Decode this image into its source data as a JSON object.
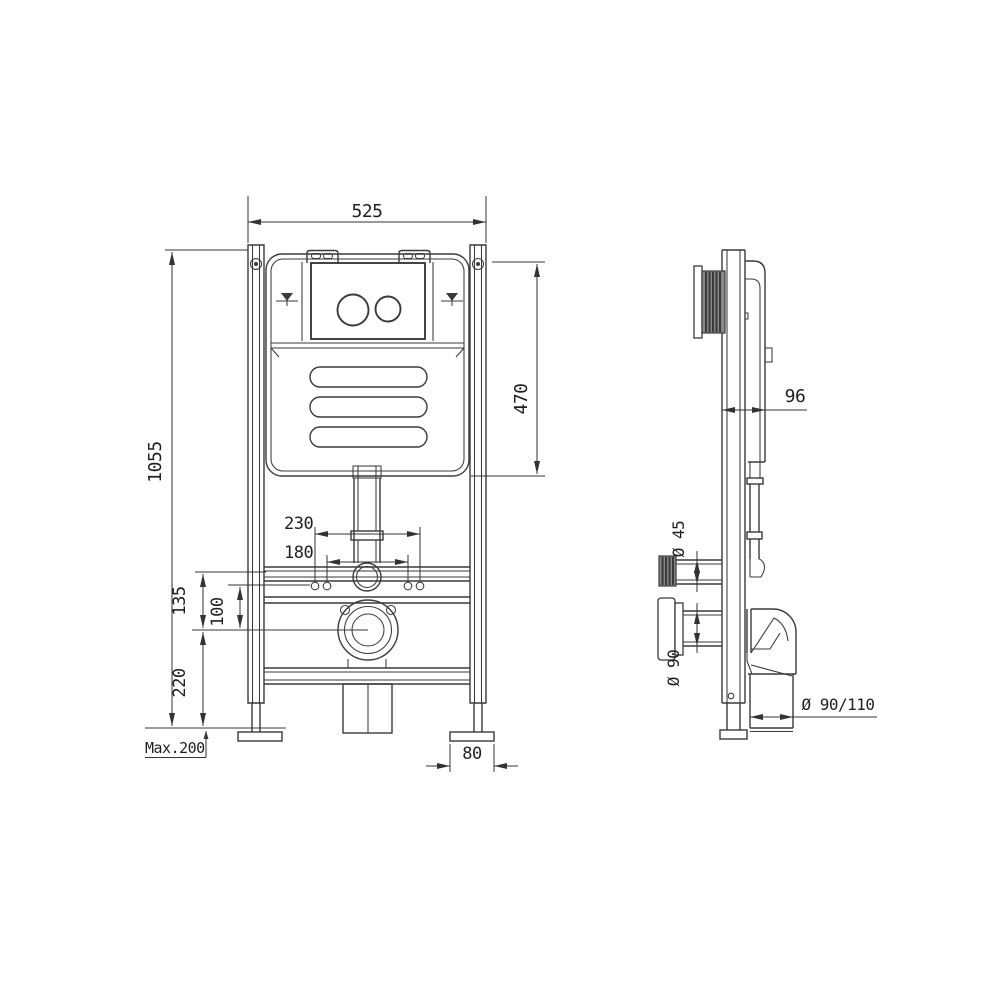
{
  "colors": {
    "bg": "#ffffff",
    "line": "#3a3a3a",
    "dim": "#333333",
    "text": "#1f1f1f",
    "fill_dark": "#8a8a8a"
  },
  "dimensions": {
    "frame_width": "525",
    "frame_height": "1055",
    "cistern_height": "470",
    "fixing_bolt_spacing_outer": "230",
    "fixing_bolt_spacing_inner": "180",
    "flush_bend_to_outlet": "135",
    "fixing_to_outlet": "100",
    "outlet_center_height": "220",
    "foot_adjustment": "Max.200",
    "foot_plate_width": "80",
    "frame_depth": "96",
    "water_inlet_diameter": "Ø 45",
    "flush_outlet_diameter": "Ø 90",
    "waste_elbow_diameter": "Ø 90/110"
  }
}
